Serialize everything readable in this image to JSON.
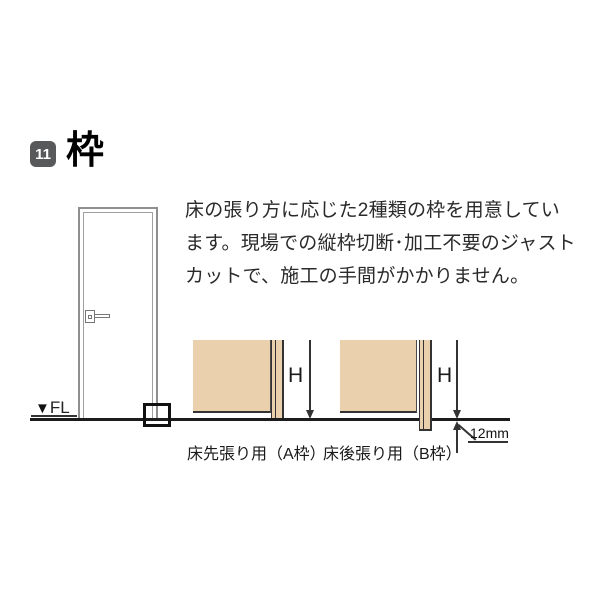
{
  "page": {
    "section_number": "11",
    "section_title": "枠",
    "description_lines": [
      "床の張り方に応じた2種類の枠を用意してい",
      "ます。現場での縦枠切断･加工不要のジャスト",
      "カットで、施工の手間がかかりません。"
    ]
  },
  "door_illustration": {
    "floor_marker": "▼",
    "floor_label": "FL"
  },
  "diagrams": {
    "dimension_label": "H",
    "frame_a": {
      "caption": "床先張り用（A枠）"
    },
    "frame_b": {
      "caption": "床後張り用（B枠）",
      "offset_label": "12mm"
    }
  },
  "colors": {
    "wall_fill": "#ead0ac",
    "badge_bg": "#58595b",
    "line_dark": "#1c1c1c",
    "door_line": "#8f8f8f",
    "text": "#2a2a2a"
  }
}
